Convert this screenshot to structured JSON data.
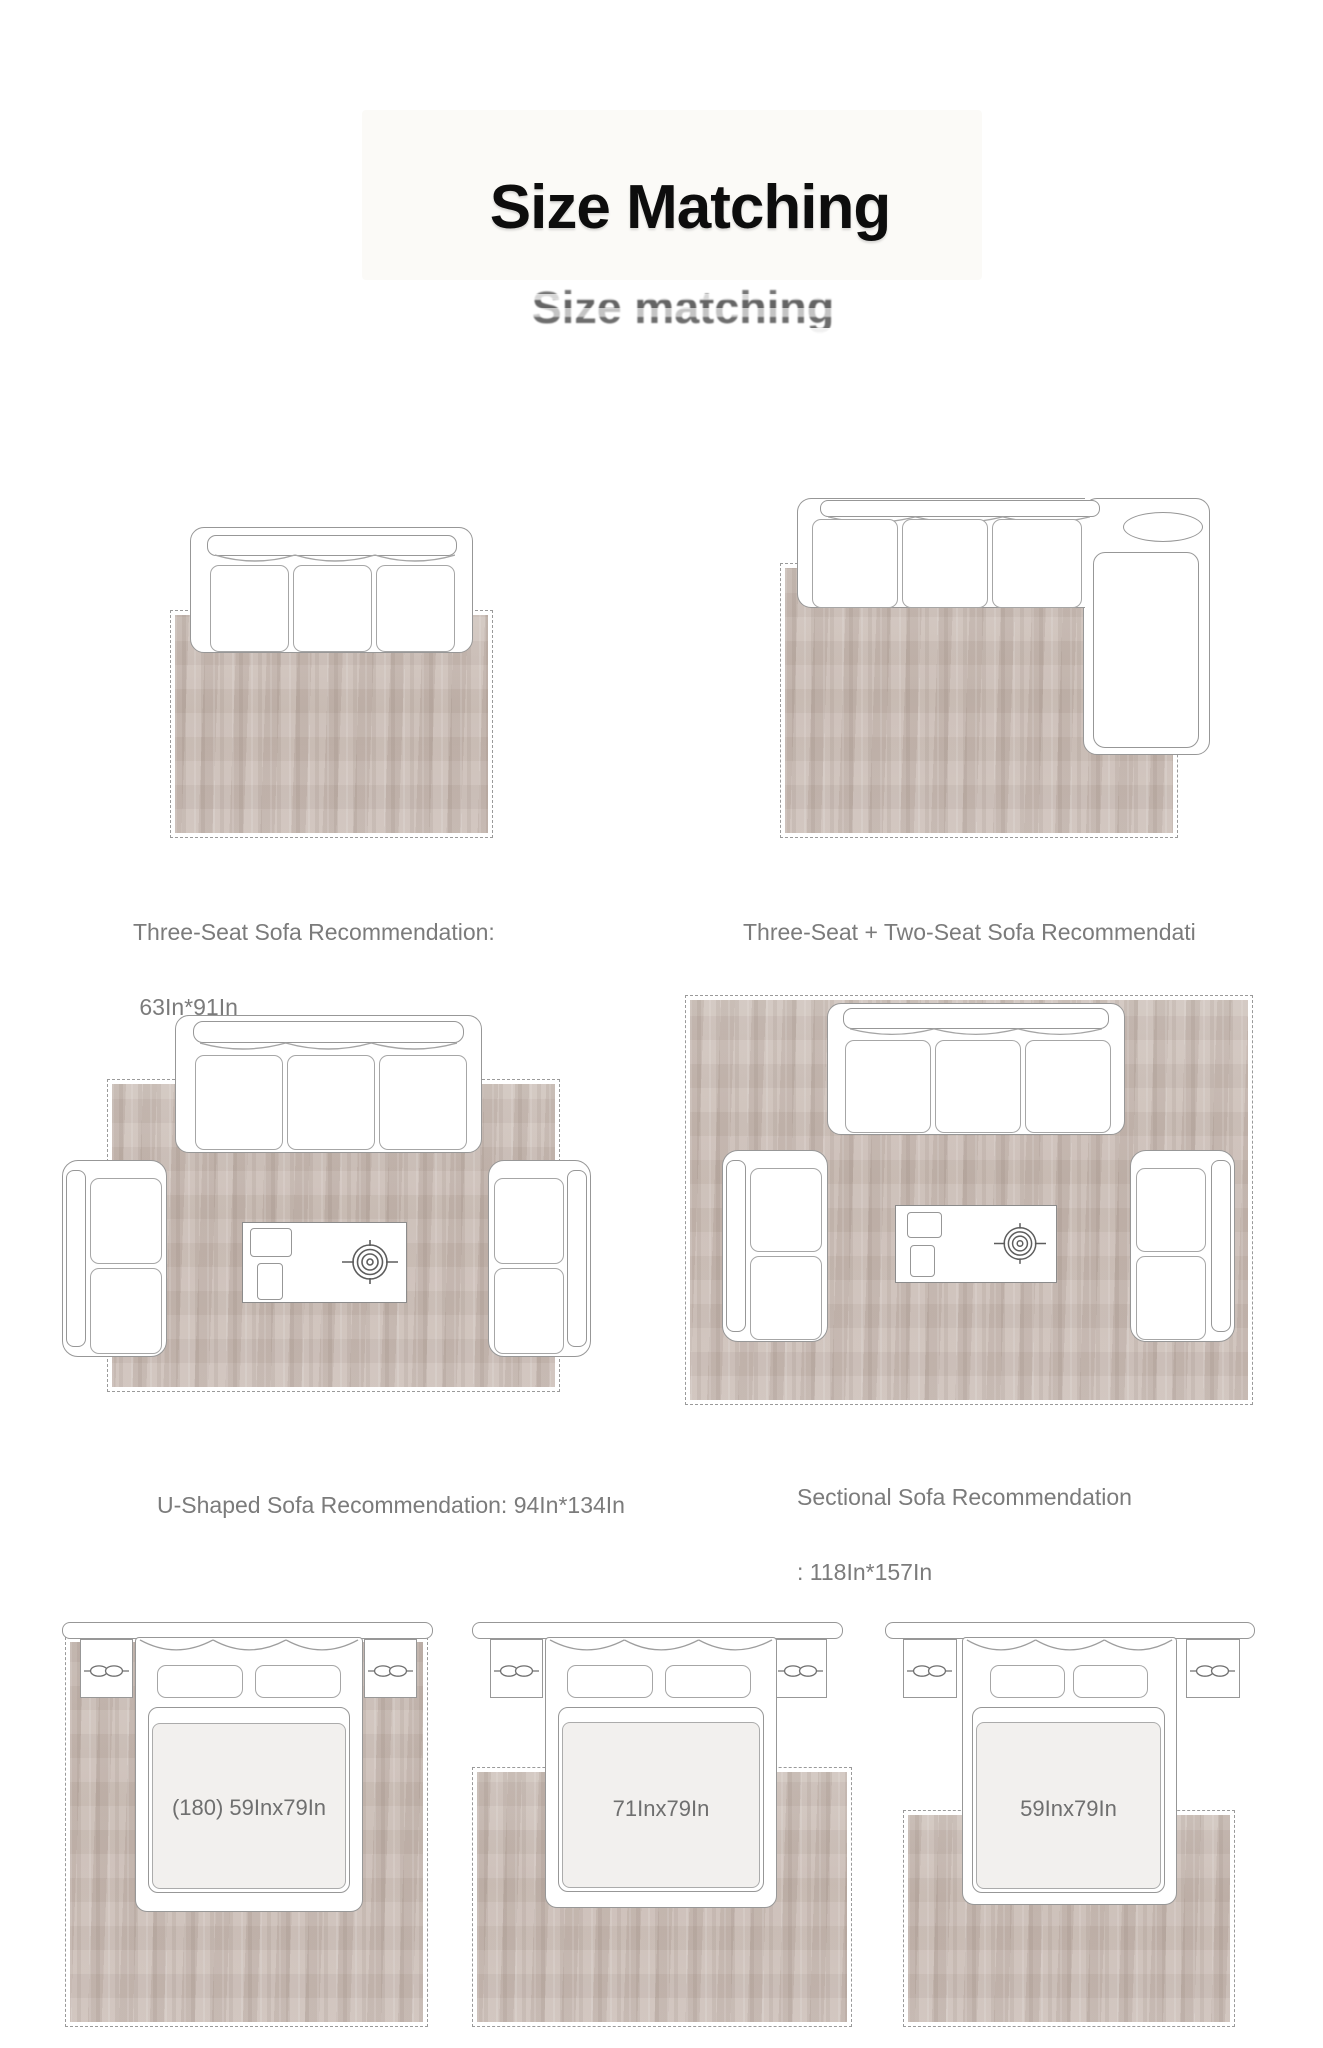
{
  "header": {
    "title": "Size Matching",
    "ghost_subtitle": "Size matching"
  },
  "colors": {
    "background": "#ffffff",
    "outline": "#979797",
    "rug_base": "#c9bcb4",
    "rug_dash": "#9a9a9a",
    "caption": "#7b7b7b",
    "title": "#0d0d0d",
    "ghost_subtitle": "#383838",
    "bed_label": "#6f6f6f"
  },
  "sofa_diagrams": [
    {
      "name": "three-seat-sofa",
      "caption_lines": [
        "Three-Seat Sofa Recommendation:",
        " 63In*91In"
      ]
    },
    {
      "name": "three-plus-two-seat-sofa",
      "caption_lines": [
        "Three-Seat + Two-Seat Sofa Recommendati",
        "on: 79In*114In"
      ]
    },
    {
      "name": "u-shaped-sofa",
      "caption_lines": [
        "U-Shaped Sofa Recommendation: 94In*134In"
      ]
    },
    {
      "name": "sectional-sofa",
      "caption_lines": [
        "Sectional Sofa Recommendation",
        ": 118In*157In"
      ]
    }
  ],
  "bed_diagrams": [
    {
      "name": "bed-full-rug",
      "label": "(180) 59Inx79In"
    },
    {
      "name": "bed-two-thirds-rug",
      "label": "71Inx79In"
    },
    {
      "name": "bed-foot-rug",
      "label": "59Inx79In"
    }
  ],
  "icons": {
    "coffee_table_decor": "target-plant-icon",
    "nightstand_handle": "drawer-handle-icon",
    "sofa_back_seam": "scallop-arcs",
    "bed_drape": "curtain-scallop-arcs"
  }
}
